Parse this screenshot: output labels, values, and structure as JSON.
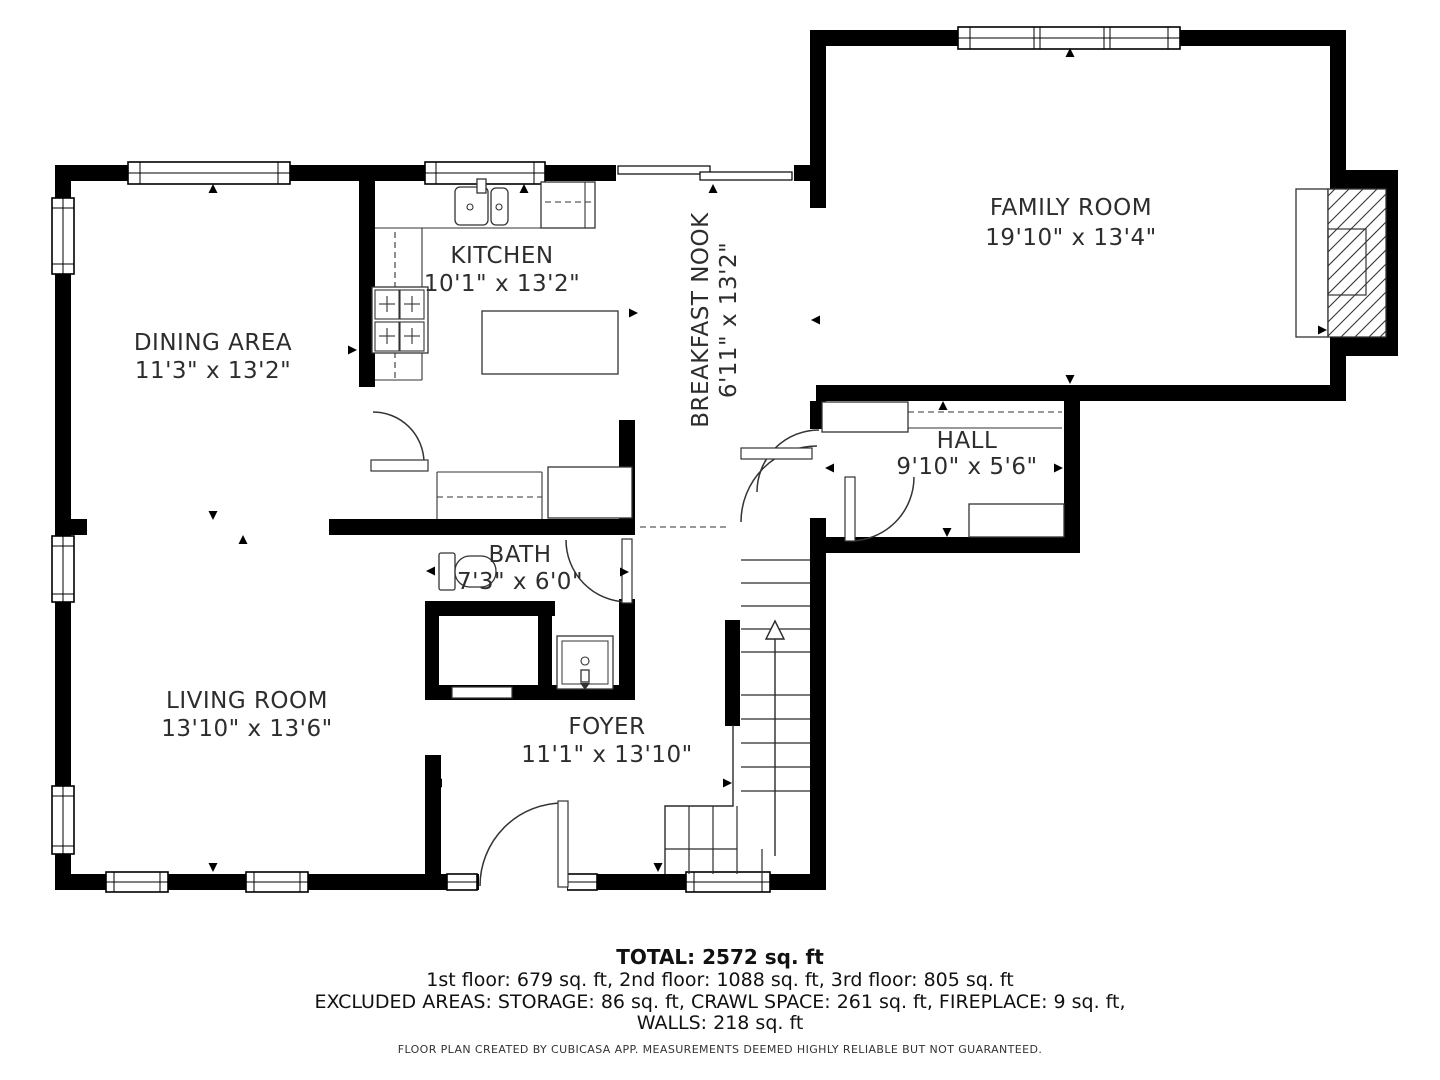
{
  "rooms": [
    {
      "name": "FAMILY ROOM",
      "dims": "19'10\" x 13'4\""
    },
    {
      "name": "KITCHEN",
      "dims": "10'1\" x 13'2\""
    },
    {
      "name": "BREAKFAST NOOK",
      "dims": "6'11\" x 13'2\""
    },
    {
      "name": "DINING AREA",
      "dims": "11'3\" x 13'2\""
    },
    {
      "name": "HALL",
      "dims": "9'10\" x 5'6\""
    },
    {
      "name": "BATH",
      "dims": "7'3\" x 6'0\""
    },
    {
      "name": "LIVING ROOM",
      "dims": "13'10\" x 13'6\""
    },
    {
      "name": "FOYER",
      "dims": "11'1\" x 13'10\""
    }
  ],
  "summary": {
    "total": "TOTAL: 2572 sq. ft",
    "floors": "1st floor: 679 sq. ft, 2nd floor: 1088 sq. ft, 3rd floor: 805 sq. ft",
    "excluded": "EXCLUDED AREAS: STORAGE: 86 sq. ft, CRAWL SPACE: 261 sq. ft, FIREPLACE: 9 sq. ft,",
    "walls": "WALLS: 218 sq. ft",
    "disclaimer": "FLOOR PLAN CREATED BY CUBICASA APP. MEASUREMENTS DEEMED HIGHLY RELIABLE BUT NOT GUARANTEED."
  },
  "colors": {
    "wall": "#000000",
    "background": "#ffffff",
    "text": "#2d2d2d"
  }
}
